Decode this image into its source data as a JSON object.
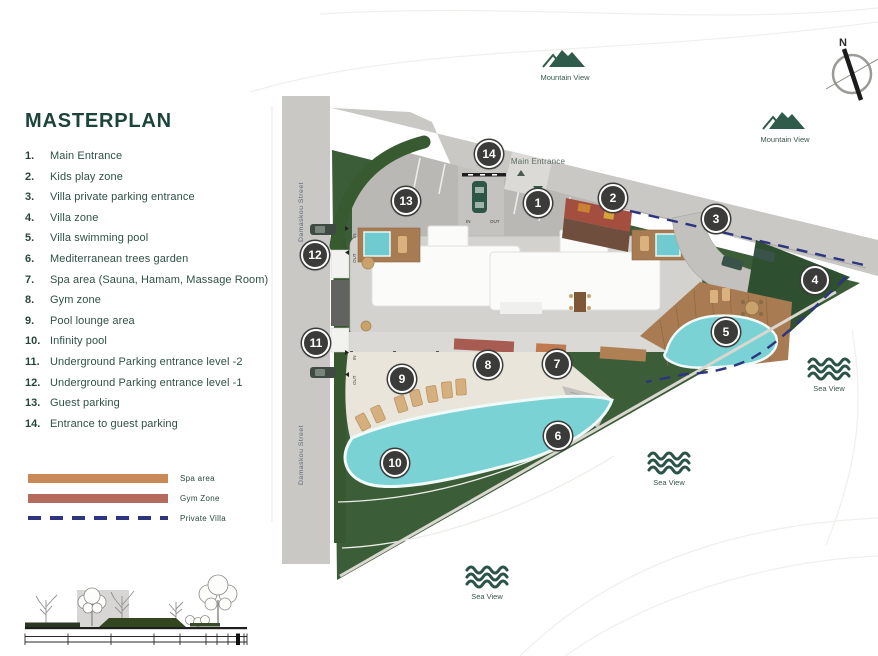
{
  "title": "MASTERPLAN",
  "legend": {
    "items": [
      {
        "num": "1.",
        "label": "Main Entrance"
      },
      {
        "num": "2.",
        "label": "Kids play zone"
      },
      {
        "num": "3.",
        "label": "Villa private parking entrance"
      },
      {
        "num": "4.",
        "label": "Villa zone"
      },
      {
        "num": "5.",
        "label": "Villa swimming pool"
      },
      {
        "num": "6.",
        "label": "Mediterranean trees garden"
      },
      {
        "num": "7.",
        "label": "Spa area (Sauna, Hamam, Massage Room)"
      },
      {
        "num": "8.",
        "label": "Gym zone"
      },
      {
        "num": "9.",
        "label": "Pool lounge area"
      },
      {
        "num": "10.",
        "label": "Infinity pool"
      },
      {
        "num": "11.",
        "label": "Underground Parking entrance level -2"
      },
      {
        "num": "12.",
        "label": "Underground Parking entrance level -1"
      },
      {
        "num": "13.",
        "label": "Guest parking"
      },
      {
        "num": "14.",
        "label": "Entrance to guest parking"
      }
    ]
  },
  "key": {
    "items": [
      {
        "label": "Spa area",
        "color": "#C98A58",
        "style": "solid"
      },
      {
        "label": "Gym Zone",
        "color": "#B56A5E",
        "style": "solid"
      },
      {
        "label": "Private Villa",
        "color": "#2D3480",
        "style": "dashed"
      }
    ]
  },
  "plan": {
    "street_label": "Damaskou Street",
    "main_entrance_label": "Main Entrance",
    "in_label": "IN",
    "out_label": "OUT",
    "markers": [
      {
        "number": "1"
      },
      {
        "number": "2"
      },
      {
        "number": "3"
      },
      {
        "number": "4"
      },
      {
        "number": "5"
      },
      {
        "number": "6"
      },
      {
        "number": "7"
      },
      {
        "number": "8"
      },
      {
        "number": "9"
      },
      {
        "number": "10"
      },
      {
        "number": "11"
      },
      {
        "number": "12"
      },
      {
        "number": "13"
      },
      {
        "number": "14"
      }
    ]
  },
  "views": {
    "mountain_label": "Mountain View",
    "sea_label": "Sea View"
  },
  "compass": {
    "north_label": "N"
  },
  "colors": {
    "site_green": "#3B5D37",
    "dark_green_accent": "#2B5348",
    "road_gray": "#C9C8C5",
    "pool_teal": "#7BD2D4",
    "wood_deck": "#A97B52",
    "spa_orange": "#C98A58",
    "gym_red": "#B56A5E",
    "kids_zone_red": "#A34E3F",
    "villa_boundary_navy": "#2D3480"
  }
}
